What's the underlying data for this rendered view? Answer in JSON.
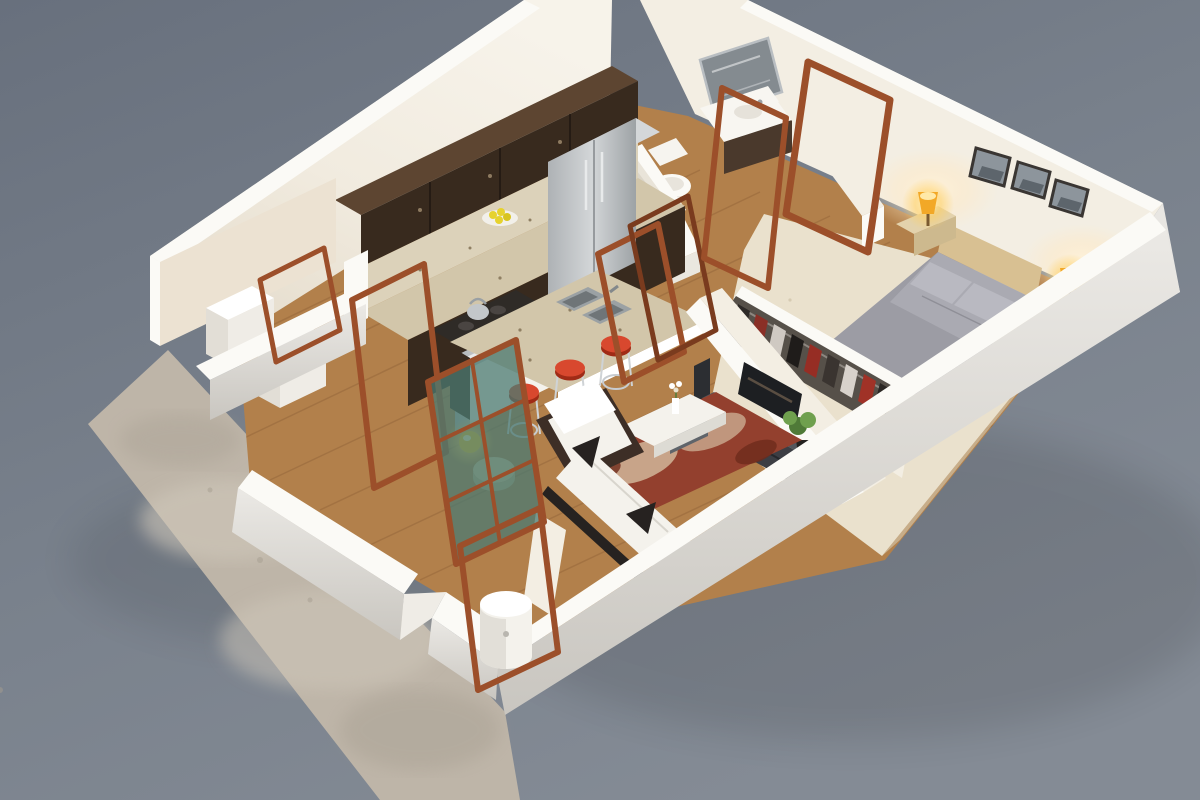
{
  "scene": {
    "description": "3D isometric cutaway render of a one-bedroom apartment floor plan on a gray studio background",
    "view": "isometric-cutaway",
    "rooms": [
      {
        "name": "kitchen",
        "items": [
          "upper-cabinets",
          "granite-backsplash",
          "granite-counter",
          "range-with-kettle",
          "oven",
          "base-cabinets",
          "refrigerator",
          "plate-of-lemons",
          "island-with-double-sink",
          "bar-stools-x3"
        ]
      },
      {
        "name": "bathroom",
        "items": [
          "wall-mirror",
          "vanity-with-sink",
          "toilet",
          "bathtub",
          "step-block"
        ]
      },
      {
        "name": "bedroom",
        "items": [
          "double-bed",
          "gray-duvet",
          "pillows-x2",
          "striped-throw",
          "nightstands-x2",
          "lit-lamps-x2",
          "framed-pictures-x3",
          "wardrobe-with-clothes"
        ]
      },
      {
        "name": "living-room",
        "items": [
          "white-armchair",
          "white-chaise-sofa",
          "dark-accent-pillows",
          "patterned-rug",
          "coffee-table-with-vase",
          "tv-console",
          "television",
          "speaker",
          "potted-plant",
          "glowing-side-lamp",
          "round-pouf"
        ]
      },
      {
        "name": "entry-hall",
        "items": [
          "open-wood-door-frames",
          "glazed-french-door",
          "white-cylindrical-bin"
        ]
      },
      {
        "name": "utility-closet",
        "items": [
          "washer",
          "dryer"
        ]
      },
      {
        "name": "patio",
        "items": [
          "concrete-slab"
        ]
      }
    ],
    "stool_count": 3,
    "picture_count": 3,
    "lamp_count": 3
  },
  "palette": {
    "bg_top": "#667029",
    "bg_top_fix": "#68707d",
    "bg_bottom": "#848b95",
    "patio": "#beb5a8",
    "patio_light": "#cfc7ba",
    "patio_dark": "#a59d90",
    "wall_bright": "#fbfaf6",
    "wall_face": "#f3eee3",
    "wall_cream": "#ece2d2",
    "wall_shadow": "#d9d0bf",
    "wall_ext": "#e8e6e2",
    "wall_ext_dark": "#cfccc6",
    "wood": "#b5834e",
    "wood_dark": "#9a6c3d",
    "wood_line": "#845a33",
    "carpet": "#eae1cd",
    "carpet_dark": "#d6cbb2",
    "espresso": "#382a1e",
    "espresso_hi": "#5d4531",
    "granite": "#d2c6aa",
    "granite_light": "#dcd2ba",
    "granite_dot": "#8f7f63",
    "steel": "#c3c7ca",
    "steel_dark": "#8e9497",
    "red_stool": "#d8482e",
    "red_dark": "#a02b16",
    "rug_red": "#93402e",
    "rug_cream": "#d9c5a8",
    "white_soft": "#f4f2ec",
    "dark_cushion": "#262220",
    "door_wood": "#9c4f2a",
    "door_wood_dark": "#7a3b1e",
    "glass_teal": "#4b7a72",
    "amber": "#f2a827",
    "lamp_yellow": "#f7c32a",
    "duvet": "#9c9ca4",
    "duvet_hi": "#b6b6be",
    "bed_wood": "#d8c092",
    "tv_dark": "#1d1f22",
    "unit_dark": "#3c3e44",
    "unit_top": "#54565c",
    "plant_green": "#4f7a38",
    "plant_green_hi": "#6fa04e",
    "photo_gray": "#8d959c",
    "frame_dark": "#3a3633",
    "lemon": "#e6d22e"
  }
}
